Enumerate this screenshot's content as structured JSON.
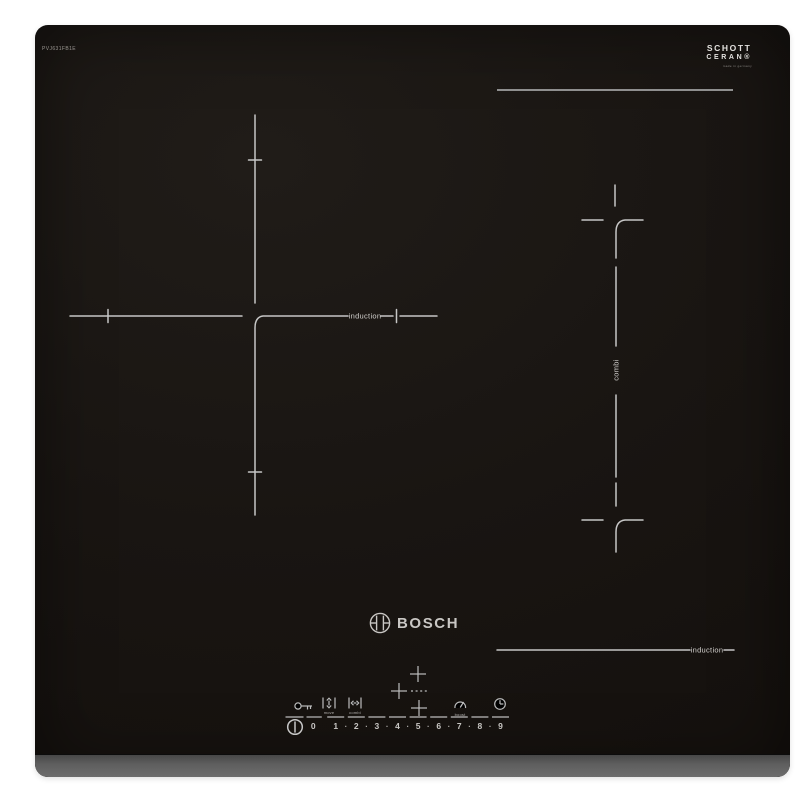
{
  "branding": {
    "model": "PVJ631FB1E",
    "brand": "BOSCH",
    "glass_line1": "SCHOTT",
    "glass_line2": "CERAN®",
    "glass_subtext": "made in germany"
  },
  "zones": {
    "left_zone_label": "induction",
    "combi_zone_label": "combi",
    "right_zone_label": "induction"
  },
  "control_panel": {
    "move_label": "move",
    "combi_label": "combi",
    "boost_label": "boost",
    "levels": [
      "0",
      "1",
      "2",
      "3",
      "4",
      "5",
      "6",
      "7",
      "8",
      "9"
    ],
    "level_separator": "·"
  },
  "icons": [
    "child-lock-key-icon",
    "move-zone-icon",
    "combi-zone-icon",
    "plus-top-icon",
    "plus-left-icon",
    "plus-bottom-icon",
    "boost-gauge-icon",
    "timer-clock-icon",
    "power-icon",
    "bosch-anchor-icon"
  ],
  "colors": {
    "glass": "#1a1613",
    "marking": "#c6c6c6",
    "boundary_line": "#8f8f8f",
    "front_trim": "#5e5e5e",
    "text": "#c9c7c4"
  }
}
